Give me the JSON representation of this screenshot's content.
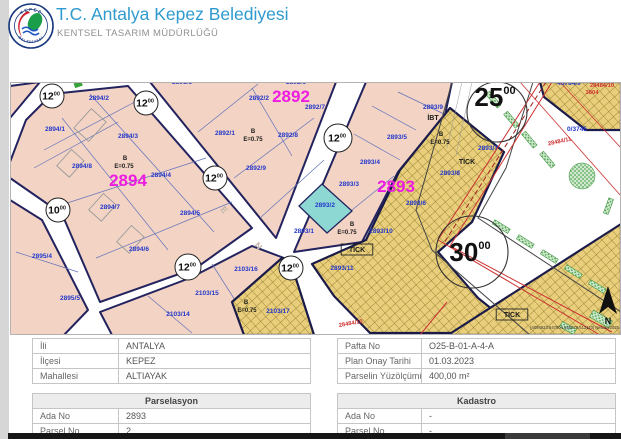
{
  "header": {
    "title": "T.C. Antalya Kepez Belediyesi",
    "subtitle": "KENTSEL TASARIM MÜDÜRLÜĞÜ",
    "logo_top": "KEPEZ",
    "logo_bottom": "BELEDİYESİ"
  },
  "map": {
    "colors": {
      "block_fill": "#f3d4c4",
      "commercial_hatch": "#e9cf7c",
      "subject_parcel": "#8ed8d4",
      "block_number": "#ee1ce2",
      "parcel_number": "#2337cc",
      "boundary": "#1b1b4a",
      "plan_boundary_red": "#cc3333",
      "vegetation_green": "#3aa23a"
    },
    "big_labels": [
      {
        "text": "2894",
        "x": 128,
        "y": 186
      },
      {
        "text": "2892",
        "x": 291,
        "y": 102
      },
      {
        "text": "2893",
        "x": 396,
        "y": 192
      }
    ],
    "parcel_labels": [
      {
        "text": "2894/2",
        "x": 99,
        "y": 100
      },
      {
        "text": "2894/1",
        "x": 55,
        "y": 131
      },
      {
        "text": "2894/3",
        "x": 128,
        "y": 138
      },
      {
        "text": "2894/8",
        "x": 82,
        "y": 168
      },
      {
        "text": "2894/4",
        "x": 161,
        "y": 177
      },
      {
        "text": "2894/5",
        "x": 190,
        "y": 215
      },
      {
        "text": "2894/7",
        "x": 110,
        "y": 209
      },
      {
        "text": "2894/6",
        "x": 139,
        "y": 251
      },
      {
        "text": "2895/4",
        "x": 42,
        "y": 258
      },
      {
        "text": "2895/5",
        "x": 70,
        "y": 300
      },
      {
        "text": "2103/16",
        "x": 246,
        "y": 271
      },
      {
        "text": "2103/15",
        "x": 207,
        "y": 295
      },
      {
        "text": "2103/14",
        "x": 178,
        "y": 316
      },
      {
        "text": "2103/17",
        "x": 278,
        "y": 313
      },
      {
        "text": "2892/2",
        "x": 259,
        "y": 100
      },
      {
        "text": "2892/7",
        "x": 315,
        "y": 109
      },
      {
        "text": "2892/1",
        "x": 225,
        "y": 135
      },
      {
        "text": "2892/8",
        "x": 288,
        "y": 137
      },
      {
        "text": "2892/9",
        "x": 256,
        "y": 170
      },
      {
        "text": "2892/6",
        "x": 296,
        "y": 84
      },
      {
        "text": "2891/8",
        "x": 182,
        "y": 84
      },
      {
        "text": "2893/5",
        "x": 397,
        "y": 139
      },
      {
        "text": "2893/9",
        "x": 433,
        "y": 109
      },
      {
        "text": "2893/4",
        "x": 370,
        "y": 164
      },
      {
        "text": "2893/3",
        "x": 349,
        "y": 186
      },
      {
        "text": "2893/2",
        "x": 325,
        "y": 207,
        "color": "#d946c8"
      },
      {
        "text": "2893/1",
        "x": 304,
        "y": 233
      },
      {
        "text": "2893/7",
        "x": 488,
        "y": 150
      },
      {
        "text": "2893/8",
        "x": 450,
        "y": 175
      },
      {
        "text": "2893/6",
        "x": 416,
        "y": 205
      },
      {
        "text": "2893/10",
        "x": 381,
        "y": 233
      },
      {
        "text": "2893/11",
        "x": 342,
        "y": 270
      },
      {
        "text": "0/3745",
        "x": 577,
        "y": 131
      },
      {
        "text": "43784/9",
        "x": 569,
        "y": 85
      }
    ],
    "black_labels": [
      {
        "text": "B",
        "x": 125,
        "y": 160
      },
      {
        "text": "E=0.75",
        "x": 124,
        "y": 168
      },
      {
        "text": "B",
        "x": 253,
        "y": 133
      },
      {
        "text": "E=0.75",
        "x": 253,
        "y": 141
      },
      {
        "text": "B",
        "x": 441,
        "y": 136
      },
      {
        "text": "E=0.75",
        "x": 440,
        "y": 144
      },
      {
        "text": "B",
        "x": 352,
        "y": 226
      },
      {
        "text": "E=0.75",
        "x": 347,
        "y": 234
      },
      {
        "text": "B",
        "x": 246,
        "y": 304
      },
      {
        "text": "E=0.75",
        "x": 247,
        "y": 312
      },
      {
        "text": "İBT",
        "x": 433,
        "y": 120,
        "size": 1
      },
      {
        "text": "TİCK",
        "x": 467,
        "y": 164,
        "size": 1
      },
      {
        "text": "TİCK",
        "x": 357,
        "y": 252,
        "size": 1,
        "box": true
      },
      {
        "text": "TİCK",
        "x": 512,
        "y": 317,
        "size": 1,
        "box": true
      }
    ],
    "red_labels": [
      {
        "text": "28484/11",
        "x": 560,
        "y": 143,
        "rot": -12
      },
      {
        "text": "28484/10",
        "x": 351,
        "y": 325,
        "rot": -10
      },
      {
        "text": "28484/10",
        "x": 602,
        "y": 87
      },
      {
        "text": "3804",
        "x": 592,
        "y": 94
      }
    ],
    "street_letters": [
      {
        "t": "E",
        "x": 222,
        "y": 212,
        "rot": 48
      },
      {
        "t": "N",
        "x": 256,
        "y": 248,
        "rot": 48
      }
    ],
    "road_circles": [
      {
        "num": "12",
        "sup": "00",
        "x": 52,
        "y": 96,
        "r": 12
      },
      {
        "num": "12",
        "sup": "00",
        "x": 146,
        "y": 103,
        "r": 12
      },
      {
        "num": "12",
        "sup": "00",
        "x": 215,
        "y": 178,
        "r": 12
      },
      {
        "num": "12",
        "sup": "00",
        "x": 338,
        "y": 138,
        "r": 14
      },
      {
        "num": "10",
        "sup": "00",
        "x": 58,
        "y": 210,
        "r": 12
      },
      {
        "num": "12",
        "sup": "00",
        "x": 188,
        "y": 267,
        "r": 13
      },
      {
        "num": "12",
        "sup": "00",
        "x": 291,
        "y": 268,
        "r": 12
      },
      {
        "num": "30",
        "sup": "00",
        "x": 472,
        "y": 252,
        "r": 36,
        "big": true,
        "dy": 9
      },
      {
        "num": "25",
        "sup": "00",
        "x": 497,
        "y": 112,
        "r": 30,
        "big": true,
        "dy": -6
      }
    ],
    "north_label": "N",
    "credit": "[4094923.847904,555879.513110] Netcad 2025"
  },
  "tables": {
    "location": {
      "rows": [
        {
          "label": "İli",
          "value": "ANTALYA"
        },
        {
          "label": "İlçesi",
          "value": "KEPEZ"
        },
        {
          "label": "Mahallesi",
          "value": "ALTIAYAK"
        }
      ]
    },
    "plan": {
      "rows": [
        {
          "label": "Pafta No",
          "value": "O25-B-01-A-4-A"
        },
        {
          "label": "Plan Onay Tarihi",
          "value": "01.03.2023"
        },
        {
          "label": "Parselin Yüzölçümü",
          "value": "400,00 m²"
        }
      ]
    },
    "parselasyon": {
      "title": "Parselasyon",
      "rows": [
        {
          "label": "Ada No",
          "value": "2893"
        },
        {
          "label": "Parsel No",
          "value": "2"
        }
      ]
    },
    "kadastro": {
      "title": "Kadastro",
      "rows": [
        {
          "label": "Ada No",
          "value": "-"
        },
        {
          "label": "Parsel No",
          "value": "-"
        }
      ]
    }
  }
}
